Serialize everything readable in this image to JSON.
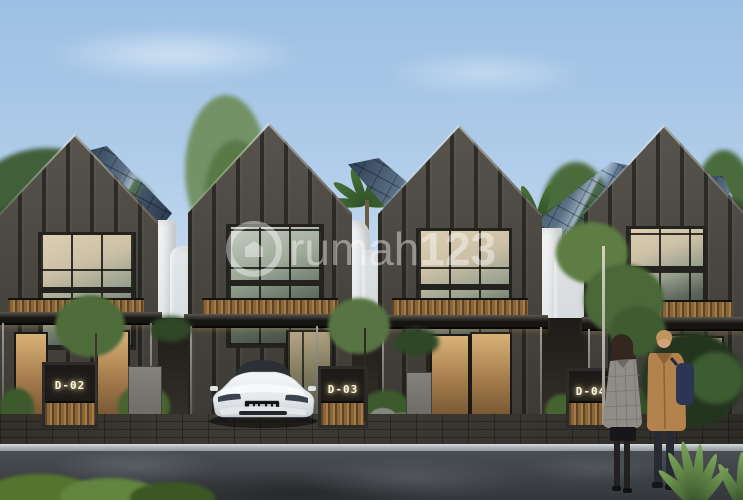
{
  "image": {
    "alt": "Architectural rendering of a row of four modern dark gabled townhouses with solar panel roofs, white side walls, carports, a white electric sedan parked under one carport, and two people standing on the street at dusk",
    "width": 743,
    "height": 500
  },
  "watermark": {
    "brand_light": "rumah",
    "brand_bold": "123",
    "icon": "home-pin-icon",
    "color": "#ffffff"
  },
  "units": [
    {
      "label": "D-02"
    },
    {
      "label": "D-03"
    },
    {
      "label": "D-04"
    }
  ],
  "palette": {
    "sky_top": "#9cc0e4",
    "sky_horizon": "#e7edf2",
    "facade_charcoal": "#4a4841",
    "facade_fin": "#1c1b18",
    "solar_roof_blue": "#5a7085",
    "white_wall": "#e9ebec",
    "wood_slat": "#8a6538",
    "canopy_dark": "#161512",
    "label_glow": "#fdf6e0",
    "car_white": "#eef0f2",
    "coat_tan": "#b4824d",
    "coat_gray_plaid": "#908d86",
    "backpack_navy": "#2c3552",
    "asphalt": "#3c4044",
    "curb": "#a8afb4",
    "hedge_green": "#55742f"
  }
}
